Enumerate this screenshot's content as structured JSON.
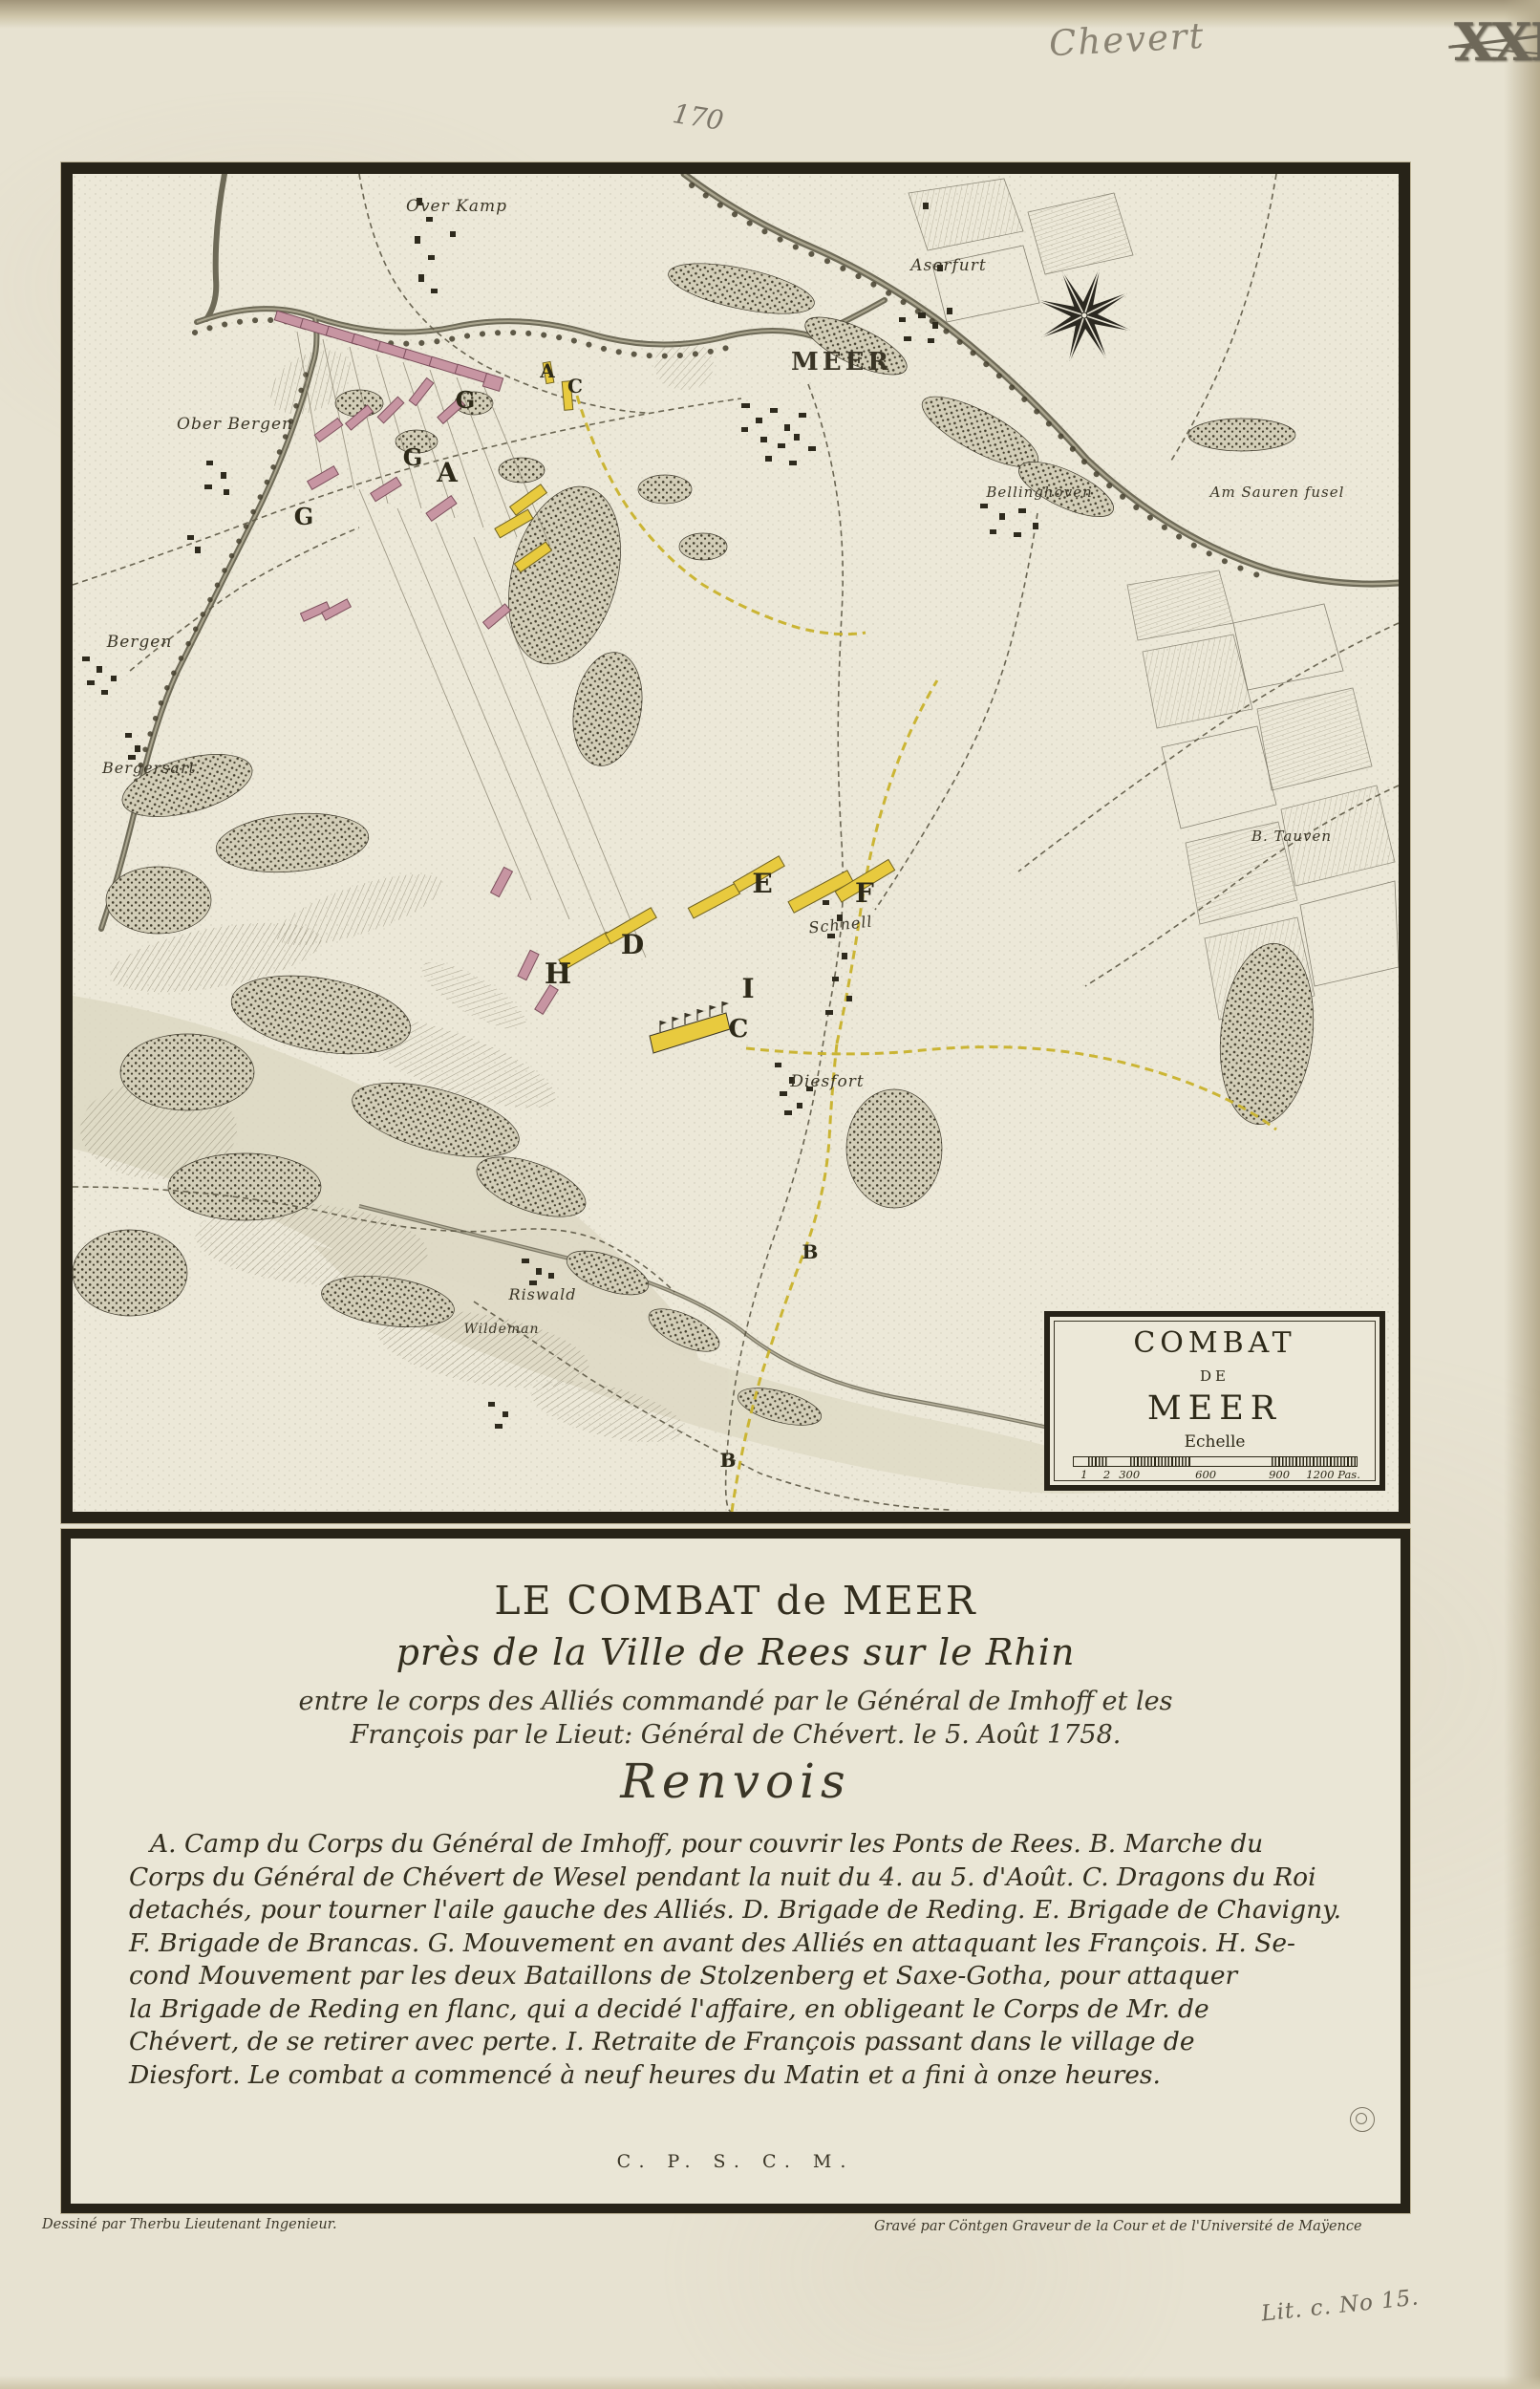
{
  "annotations": {
    "owner_pencil": "Chevert",
    "plate_stamp": "XXI",
    "page_number": "170",
    "collection_mark": "Lit. c. No 15."
  },
  "map": {
    "places": [
      "Over Kamp",
      "Aserfurt",
      "MEER",
      "Ober Bergen",
      "Bellinghoven",
      "Am Sauren fusel",
      "Bergen",
      "Bergersart",
      "B. Tauven",
      "Schnell",
      "Diesfort",
      "Riswald",
      "Wildeman"
    ],
    "letters": [
      "A",
      "A",
      "C",
      "G",
      "G",
      "G",
      "D",
      "E",
      "F",
      "H",
      "I",
      "C",
      "B",
      "B"
    ],
    "cartouche": {
      "line1": "COMBAT",
      "line2": "DE",
      "line3": "MEER",
      "scale_label": "Echelle",
      "ticks": [
        "1",
        "2",
        "300",
        "600",
        "900",
        "1200 Pas."
      ]
    },
    "colors": {
      "allied_units": "#c795a2",
      "french_units": "#e8ca3e",
      "route": "#c9b22b",
      "ink": "#272318",
      "paper": "#ece8d8"
    }
  },
  "panel": {
    "title": "LE COMBAT de MEER",
    "subtitle": "près de la Ville de Rees sur le Rhin",
    "dedication1": "entre le corps des Alliés commandé par le Général de Imhoff et les",
    "dedication2": "François par le Lieut: Général de Chévert. le 5. Août 1758.",
    "legend_heading": "Renvois",
    "legend_lines": [
      "A. Camp du Corps du Général de Imhoff, pour couvrir les Ponts de Rees.   B. Marche du",
      "Corps du Général de Chévert de Wesel pendant la nuit du 4. au 5. d'Août.   C. Dragons du Roi",
      "detachés, pour tourner l'aile gauche des Alliés. D. Brigade de Reding. E. Brigade de Chavigny.",
      "F. Brigade de Brancas.   G. Mouvement en avant des Alliés en attaquant les François.   H. Se-",
      "cond Mouvement par les deux Bataillons de Stolzenberg et Saxe-Gotha, pour attaquer",
      "la Brigade de Reding en flanc, qui a decidé l'affaire, en obligeant le Corps de Mr. de",
      "Chévert, de se retirer avec perte.   I. Retraite de François passant dans le village de",
      "Diesfort.   Le combat a commencé à neuf heures du Matin et a fini à onze heures."
    ],
    "monogram": "C. P. S. C. M."
  },
  "credits": {
    "drawn_by": "Dessiné par Therbu Lieutenant Ingenieur.",
    "engraved_by": "Gravé par Cöntgen Graveur de la Cour et de l'Université de Maÿence"
  }
}
